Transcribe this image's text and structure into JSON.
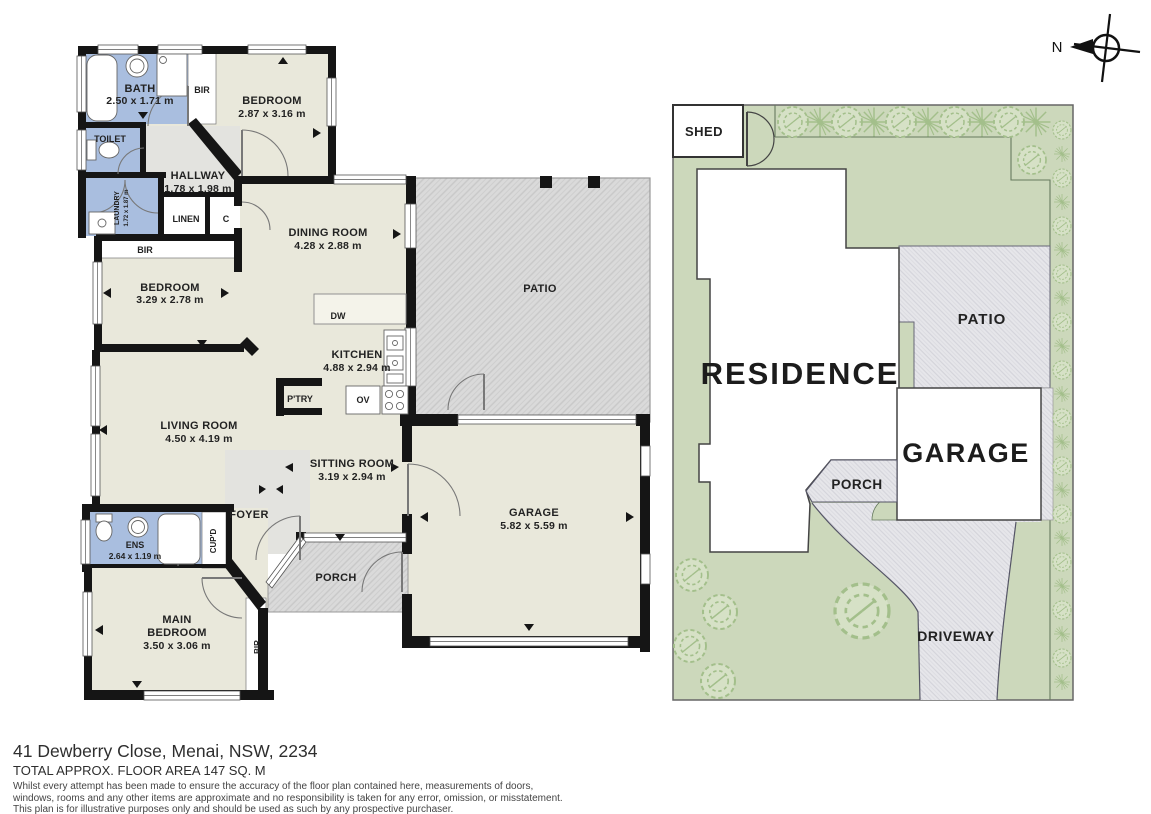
{
  "floorplan": {
    "bath": {
      "name": "BATH",
      "dims": "2.50 x 1.71 m"
    },
    "bir_top": {
      "name": "BIR"
    },
    "bedroom1": {
      "name": "BEDROOM",
      "dims": "2.87 x 3.16 m"
    },
    "toilet": {
      "name": "TOILET"
    },
    "hallway": {
      "name": "HALLWAY",
      "dims": "1.78 x 1.98 m"
    },
    "laundry": {
      "name": "LAUNDRY",
      "dims": "1.72 x 1.87 m"
    },
    "linen": {
      "name": "LINEN"
    },
    "cupboard_c": {
      "name": "C"
    },
    "bir_bed2": {
      "name": "BIR"
    },
    "bedroom2": {
      "name": "BEDROOM",
      "dims": "3.29 x 2.78 m"
    },
    "dining": {
      "name": "DINING ROOM",
      "dims": "4.28 x 2.88 m"
    },
    "patio": {
      "name": "PATIO"
    },
    "dw": {
      "name": "DW"
    },
    "kitchen": {
      "name": "KITCHEN",
      "dims": "4.88 x 2.94 m"
    },
    "pantry": {
      "name": "P'TRY"
    },
    "oven": {
      "name": "OV"
    },
    "living": {
      "name": "LIVING ROOM",
      "dims": "4.50 x 4.19 m"
    },
    "sitting": {
      "name": "SITTING ROOM",
      "dims": "3.19 x 2.94 m"
    },
    "garage": {
      "name": "GARAGE",
      "dims": "5.82 x 5.59 m"
    },
    "foyer": {
      "name": "FOYER"
    },
    "cupd": {
      "name": "CUP'D"
    },
    "ens": {
      "name": "ENS",
      "dims": "2.64 x 1.19 m"
    },
    "main_bedroom": {
      "line1": "MAIN",
      "line2": "BEDROOM",
      "dims": "3.50 x 3.06 m"
    },
    "bir_main": {
      "name": "BIR"
    },
    "porch": {
      "name": "PORCH"
    }
  },
  "siteplan": {
    "shed": "SHED",
    "residence": "RESIDENCE",
    "patio": "PATIO",
    "garage": "GARAGE",
    "porch": "PORCH",
    "driveway": "DRIVEWAY"
  },
  "compass": {
    "north": "N"
  },
  "footer": {
    "address": "41 Dewberry Close, Menai, NSW, 2234",
    "area": "TOTAL APPROX. FLOOR AREA 147 SQ. M",
    "disclaimer1": "Whilst every attempt has been made to ensure the accuracy of the floor plan contained here, measurements of doors,",
    "disclaimer2": "windows, rooms and any other items are approximate and no responsibility is taken for any error, omission, or misstatement.",
    "disclaimer3": "This plan is for illustrative purposes only and should be used as such by any prospective purchaser."
  },
  "colors": {
    "wall": "#151515",
    "room_floor": "#e9e8db",
    "hall_floor": "#e3e3df",
    "wet_area_blue": "#a9bedf",
    "patio_hatch": "#dadada",
    "site_green": "#ccd8bb",
    "site_hatch": "#e6e6ea",
    "tree_green": "#a3bf8b"
  }
}
